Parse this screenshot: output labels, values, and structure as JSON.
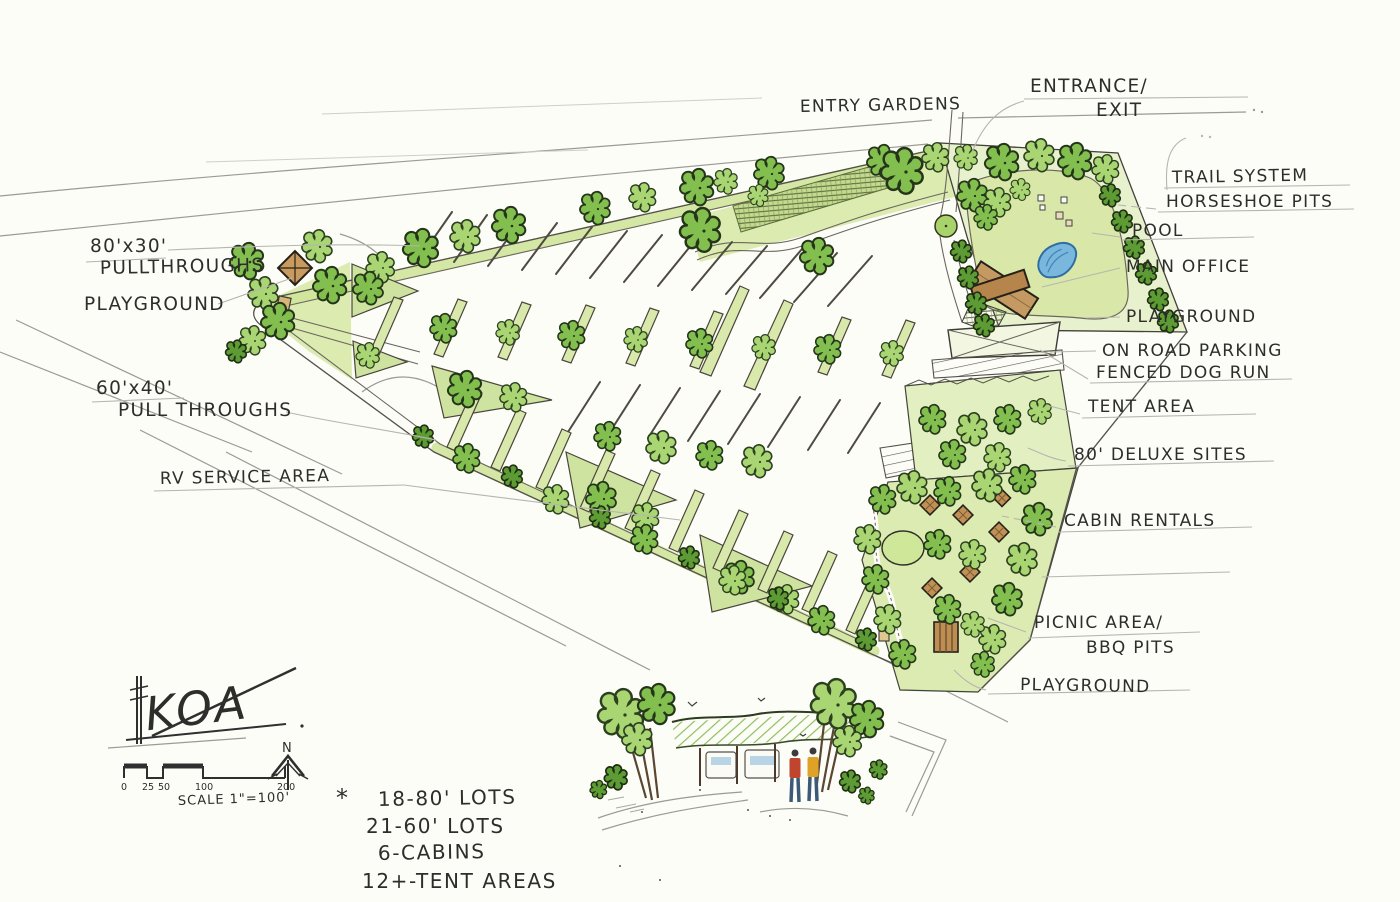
{
  "labels": {
    "entrance_exit_1": "ENTRANCE/",
    "entrance_exit_2": "EXIT",
    "entry_gardens": "ENTRY GARDENS",
    "trail_system": "TRAIL SYSTEM",
    "horseshoe_pits": "HORSESHOE PITS",
    "pool": "POOL",
    "main_office": "MAIN OFFICE",
    "playground_right": "PLAYGROUND",
    "on_road_parking": "ON ROAD PARKING",
    "fenced_dog_run": "FENCED DOG RUN",
    "tent_area": "TENT AREA",
    "deluxe_sites": "80' DELUXE SITES",
    "cabin_rentals": "CABIN RENTALS",
    "picnic_area_1": "PICNIC AREA/",
    "picnic_area_2": "BBQ PITS",
    "playground_bottom": "PLAYGROUND",
    "pullthroughs_80_1": "80'x30'",
    "pullthroughs_80_2": "PULLTHROUGHS",
    "playground_left": "PLAYGROUND",
    "pullthroughs_60_1": "60'x40'",
    "pullthroughs_60_2": "PULL THROUGHS",
    "rv_service_area": "RV SERVICE AREA"
  },
  "legend": {
    "koa": "KOA",
    "north": "N",
    "scale_caption": "SCALE 1\"=100'",
    "ticks": [
      "0",
      "25",
      "50",
      "100",
      "200"
    ]
  },
  "stats": {
    "bullet": "*",
    "items": [
      "18-80' LOTS",
      "21-60' LOTS",
      "6-CABINS",
      "12+-TENT AREAS"
    ]
  },
  "palette": {
    "paper": "#fdfdf8",
    "ink": "#2d2d2b",
    "pencil": "#9b9b95",
    "leader_gray": "#b6b6b0",
    "foliage_dark": "#5d9c34",
    "foliage_mid": "#82bf4f",
    "foliage_light": "#a9d573",
    "lawn_light": "#e4efc3",
    "lawn_mid": "#cfe49b",
    "pool_blue": "#79b7dd",
    "pool_edge": "#2f6da5",
    "roof_brown": "#c2945c",
    "shirt_red": "#c0452f",
    "shirt_yellow": "#dfa226"
  }
}
